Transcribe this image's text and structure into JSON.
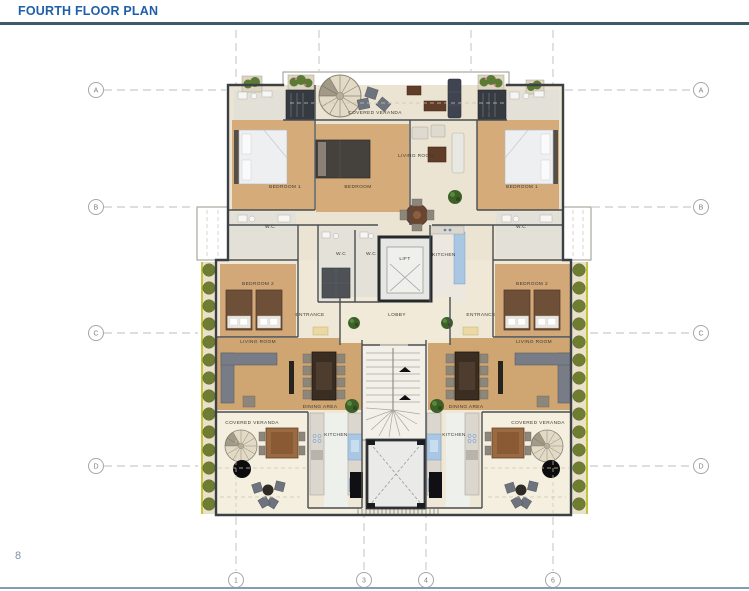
{
  "page": {
    "title": "FOURTH FLOOR PLAN",
    "page_number": "8"
  },
  "grid": {
    "row_labels": [
      "A",
      "B",
      "C",
      "D"
    ],
    "col_labels": [
      "1",
      "3",
      "4",
      "6"
    ]
  },
  "plan": {
    "rooms": [
      {
        "id": "veranda-top",
        "label": "COVERED VERANDA"
      },
      {
        "id": "wc-top-left",
        "label": "W.C"
      },
      {
        "id": "wc-top-right",
        "label": "W.C"
      },
      {
        "id": "living-top",
        "label": "LIVING ROOM"
      },
      {
        "id": "bedroom1-left",
        "label": "BEDROOM 1"
      },
      {
        "id": "bedroom-middle",
        "label": "BEDROOM"
      },
      {
        "id": "bedroom1-right",
        "label": "BEDROOM 1"
      },
      {
        "id": "wc-mid-left",
        "label": "W.C"
      },
      {
        "id": "wc-mid-right",
        "label": "W.C"
      },
      {
        "id": "wc-core-left",
        "label": "W.C"
      },
      {
        "id": "wc-core-right",
        "label": "W.C"
      },
      {
        "id": "lift",
        "label": "LIFT"
      },
      {
        "id": "kitchen-upper",
        "label": "KITCHEN"
      },
      {
        "id": "bedroom2-left",
        "label": "BEDROOM 2"
      },
      {
        "id": "bedroom2-right",
        "label": "BEDROOM 2"
      },
      {
        "id": "entrance-left",
        "label": "ENTRANCE"
      },
      {
        "id": "lobby",
        "label": "LOBBY"
      },
      {
        "id": "entrance-right",
        "label": "ENTRANCE"
      },
      {
        "id": "living-bottom-left",
        "label": "LIVING ROOM"
      },
      {
        "id": "living-bottom-right",
        "label": "LIVING ROOM"
      },
      {
        "id": "dining-left",
        "label": "DINING AREA"
      },
      {
        "id": "dining-right",
        "label": "DINING AREA"
      },
      {
        "id": "kitchen-bottom-left",
        "label": "KITCHEN"
      },
      {
        "id": "kitchen-bottom-right",
        "label": "KITCHEN"
      },
      {
        "id": "veranda-bottom-left",
        "label": "COVERED VERANDA"
      },
      {
        "id": "veranda-bottom-right",
        "label": "COVERED VERANDA"
      }
    ]
  },
  "colors": {
    "title_text": "#1f5fa8",
    "header_rule": "#3d5a6b",
    "footer_rule": "#7fa0b2",
    "page_number": "#8090a4",
    "grid_line": "#bdbdbd",
    "wall": "#3b4045",
    "floor_cream": "#efe8d6",
    "floor_wood": "#d4aa79",
    "tile": "#e3e0d8",
    "kitchen_counter_blue": "#a9c7e2",
    "hedge_green": "#6f7d33",
    "hedge_edge_yellow": "#c3c437",
    "veranda_floor": "#f5efdf",
    "plant_green": "#3c6028"
  }
}
